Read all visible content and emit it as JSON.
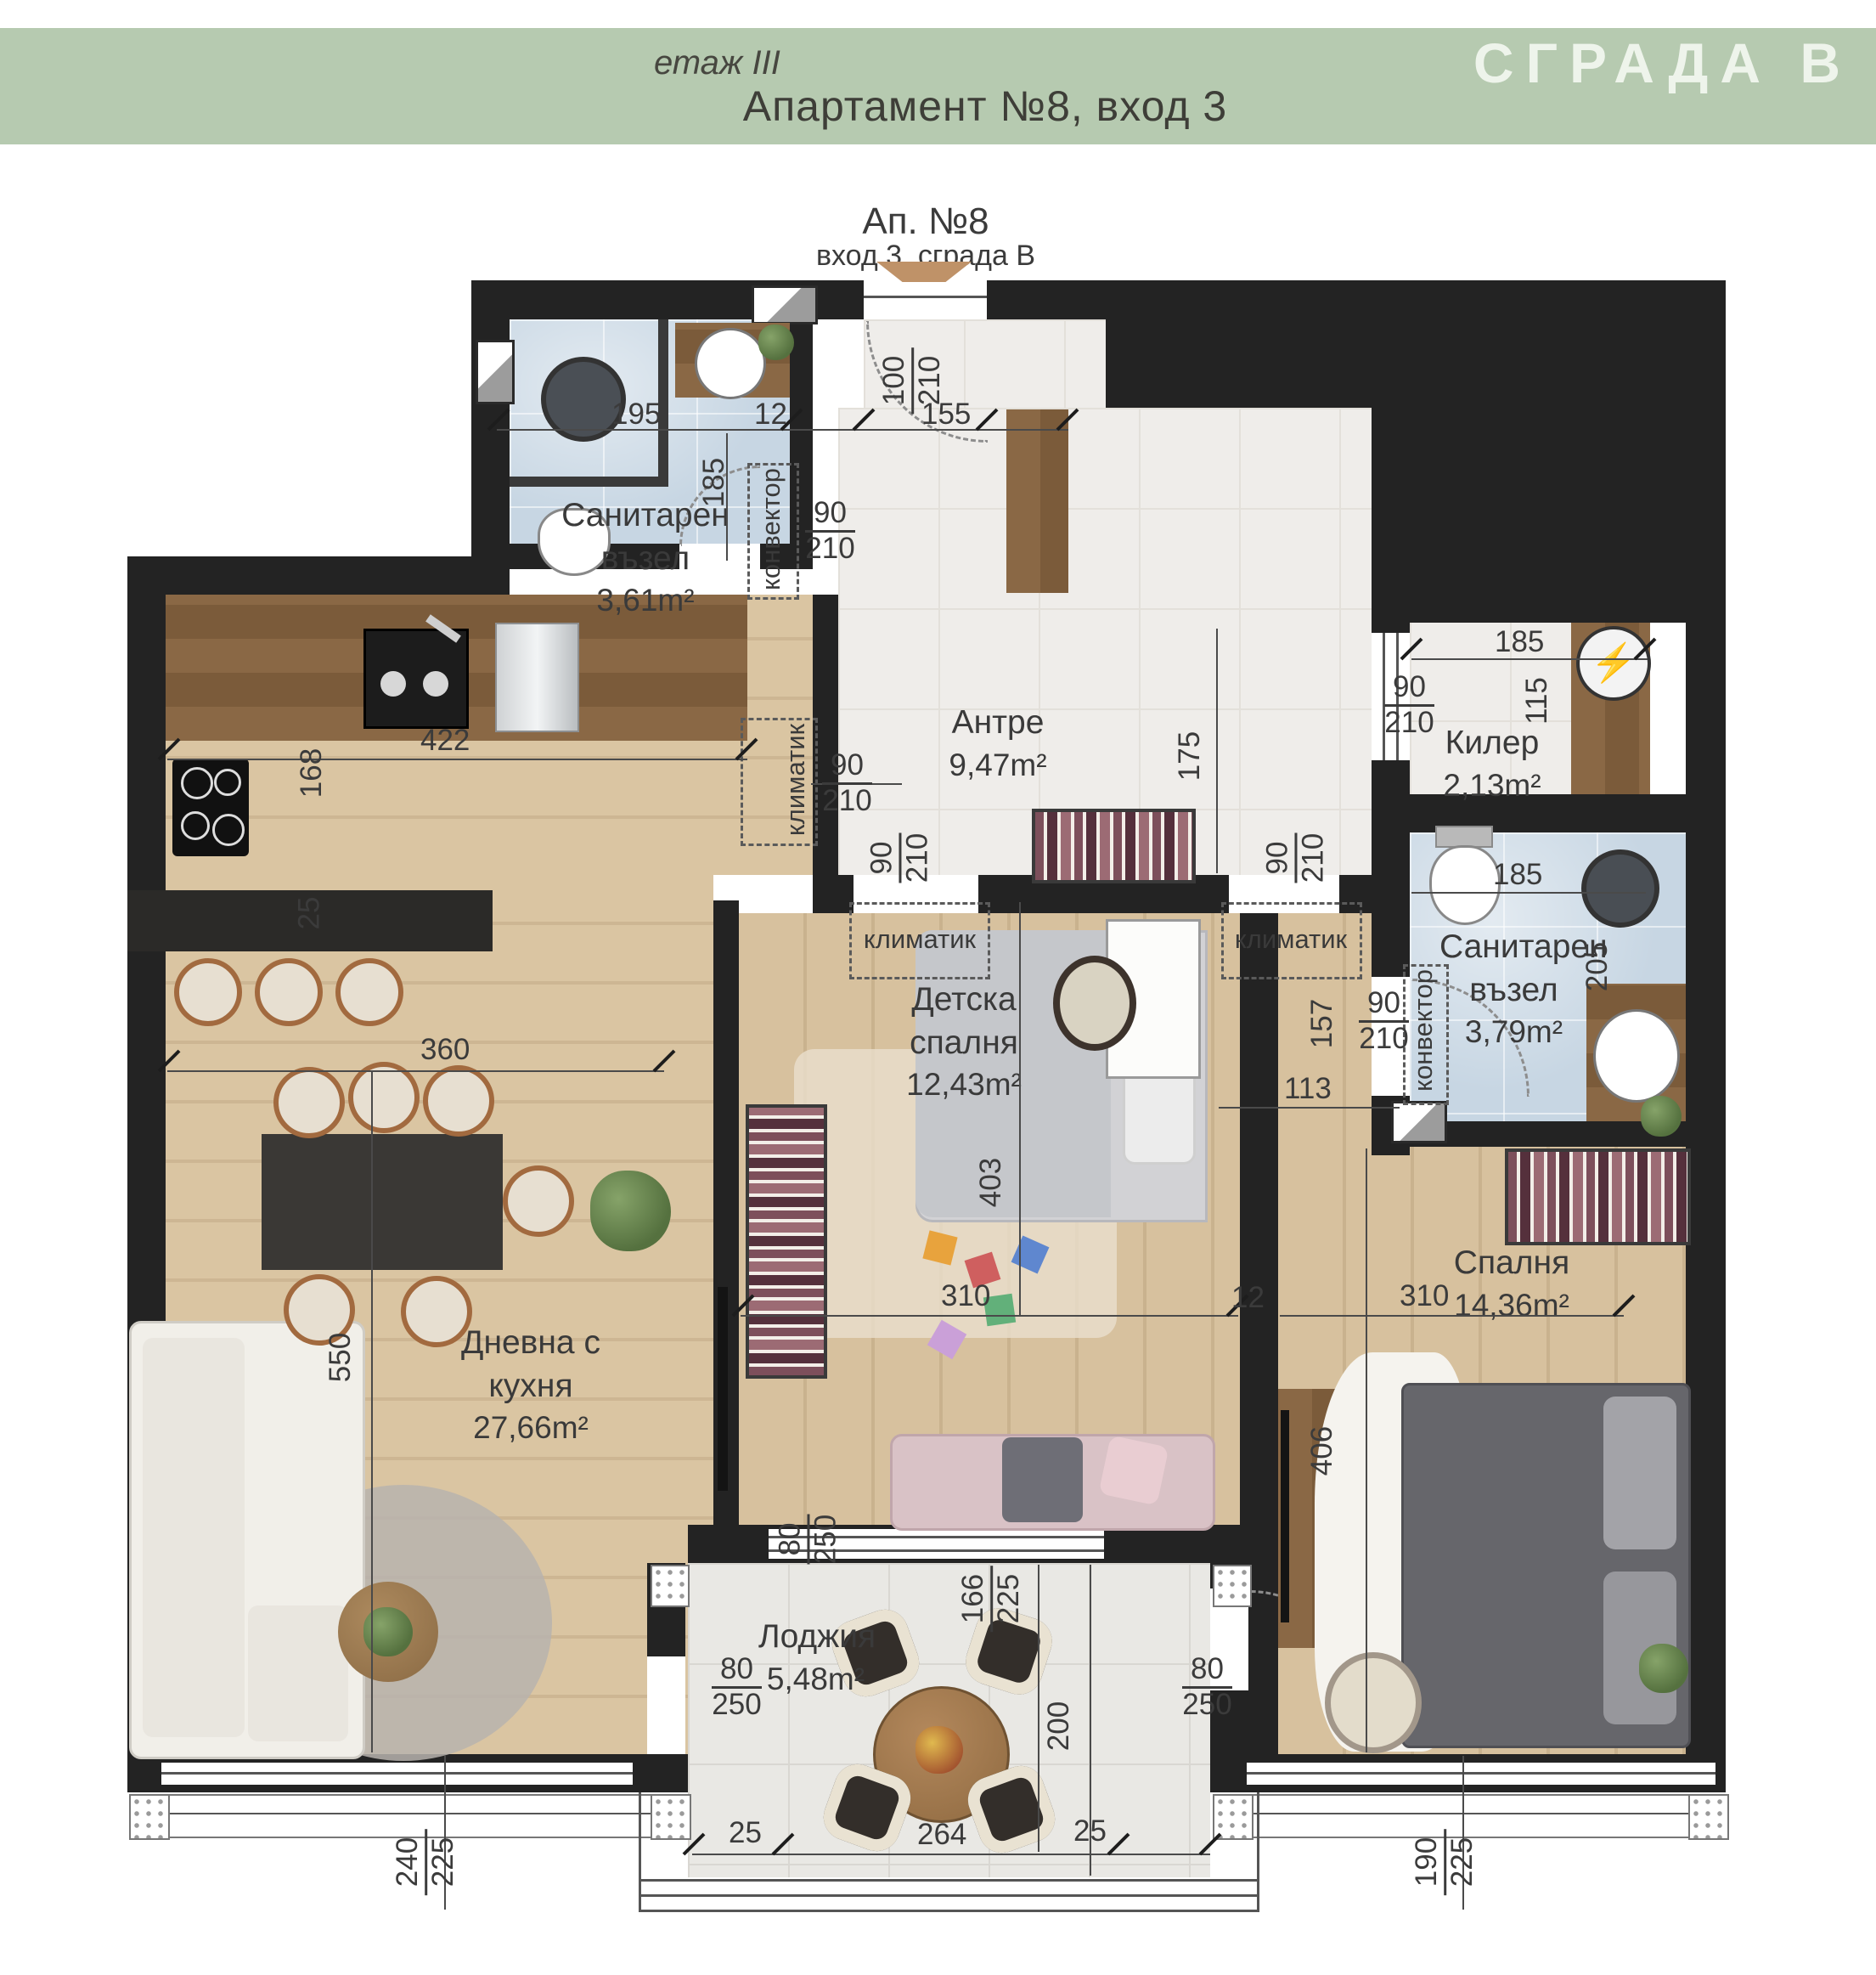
{
  "header": {
    "floor": "етаж III",
    "title": "Апартамент №8, вход 3",
    "building": "СГРАДА В"
  },
  "entrance": {
    "name": "Ап. №8",
    "sub": "вход 3, сграда В"
  },
  "rooms": {
    "bath1": {
      "name": "Санитарен възел",
      "area": "3,61m²"
    },
    "hall": {
      "name": "Антре",
      "area": "9,47m²"
    },
    "storage": {
      "name": "Килер",
      "area": "2,13m²"
    },
    "kids": {
      "name": "Детска спалня",
      "area": "12,43m²"
    },
    "bath2": {
      "name": "Санитарен възел",
      "area": "3,79m²"
    },
    "bedroom": {
      "name": "Спалня",
      "area": "14,36m²"
    },
    "living": {
      "name": "Дневна с кухня",
      "area": "27,66m²"
    },
    "loggia": {
      "name": "Лоджия",
      "area": "5,48m²"
    }
  },
  "labels": {
    "convector": "конвектор",
    "ac": "климатик"
  },
  "dims": {
    "n12": "12",
    "n25": "25",
    "n80": "80",
    "n90": "90",
    "n100": "100",
    "n113": "113",
    "n115": "115",
    "n155": "155",
    "n157": "157",
    "n166": "166",
    "n168": "168",
    "n175": "175",
    "n185": "185",
    "n190": "190",
    "n195": "195",
    "n200": "200",
    "n205": "205",
    "n210": "210",
    "n225": "225",
    "n240": "240",
    "n250": "250",
    "n264": "264",
    "n310": "310",
    "n360": "360",
    "n403": "403",
    "n406": "406",
    "n422": "422",
    "n550": "550"
  },
  "colors": {
    "accent_green": "#b6cab0",
    "building_text": "#eef2ea",
    "wall": "#232323",
    "dim_text": "#3b3b3b",
    "arrow_tan": "#bf9268"
  }
}
